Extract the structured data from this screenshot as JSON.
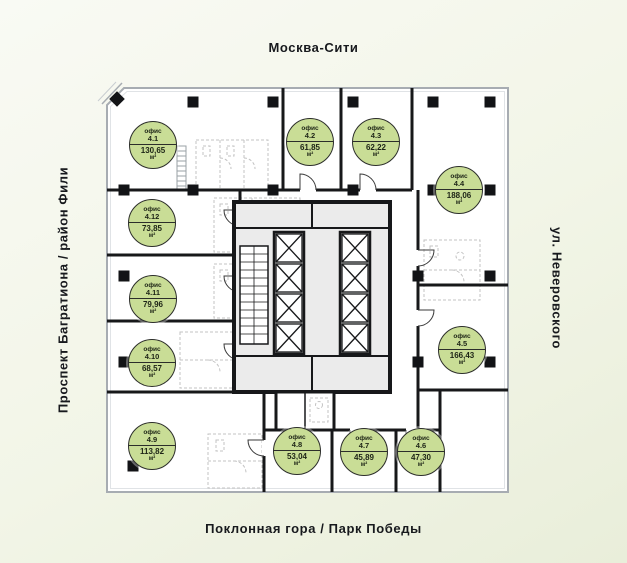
{
  "surroundings": {
    "top": "Москва-Сити",
    "right": "ул. Неверовского",
    "bottom": "Поклонная гора / Парк Победы",
    "left": "Проспект Багратиона / район Фили"
  },
  "plan": {
    "office_label": "офис",
    "area_unit": "м²",
    "badge_color": "#c9dd96",
    "offices": [
      {
        "number": "4.1",
        "area": "130,65",
        "x": 153,
        "y": 145
      },
      {
        "number": "4.2",
        "area": "61,85",
        "x": 310,
        "y": 142
      },
      {
        "number": "4.3",
        "area": "62,22",
        "x": 376,
        "y": 142
      },
      {
        "number": "4.4",
        "area": "188,06",
        "x": 459,
        "y": 190
      },
      {
        "number": "4.5",
        "area": "166,43",
        "x": 462,
        "y": 350
      },
      {
        "number": "4.6",
        "area": "47,30",
        "x": 421,
        "y": 452
      },
      {
        "number": "4.7",
        "area": "45,89",
        "x": 364,
        "y": 452
      },
      {
        "number": "4.8",
        "area": "53,04",
        "x": 297,
        "y": 451
      },
      {
        "number": "4.9",
        "area": "113,82",
        "x": 152,
        "y": 446
      },
      {
        "number": "4.10",
        "area": "68,57",
        "x": 152,
        "y": 363
      },
      {
        "number": "4.11",
        "area": "79,96",
        "x": 153,
        "y": 299
      },
      {
        "number": "4.12",
        "area": "73,85",
        "x": 152,
        "y": 223
      }
    ]
  }
}
